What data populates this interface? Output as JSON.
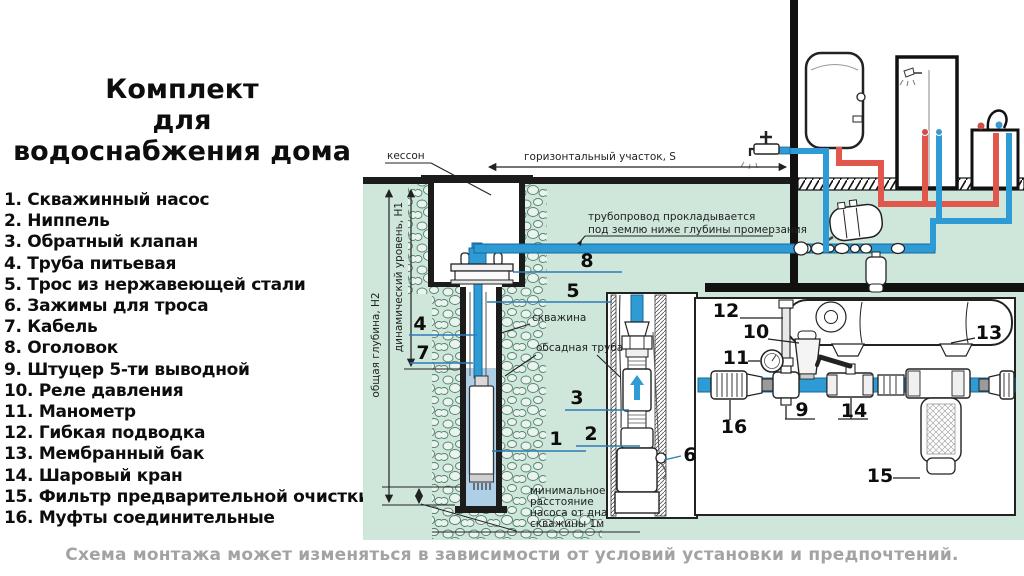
{
  "title": {
    "lines": [
      "Комплект",
      "для",
      "водоснабжения дома"
    ]
  },
  "legend": {
    "items": [
      "1. Скважинный насос",
      "2. Ниппель",
      "3. Обратный клапан",
      "4. Труба питьевая",
      "5. Трос из нержавеющей стали",
      "6. Зажимы для троса",
      "7. Кабель",
      "8. Оголовок",
      "9. Штуцер 5-ти выводной",
      "10. Реле давления",
      "11. Манометр",
      "12. Гибкая подводка",
      "13. Мембранный бак",
      "14. Шаровый кран",
      "15. Фильтр предварительной очистки",
      "16. Муфты соединительные"
    ]
  },
  "caption": {
    "text": "Схема монтажа может изменяться в зависимости от условий установки и предпочтений."
  },
  "diagram": {
    "labels": {
      "kesson": "кессон",
      "horizontal_section": "горизонтальный участок, S",
      "pipeline_note": [
        "трубопровод прокладывается",
        "под землю ниже глубины промерзания"
      ],
      "total_depth": "общая глубина, Н2",
      "dynamic_level": "динамический уровень, Н1",
      "borehole": "скважина",
      "casing": "обсадная труба",
      "min_distance": [
        "минимальное",
        "расстояние",
        "насоса от дна",
        "скважины 1м"
      ]
    },
    "callouts": {
      "n1": "1",
      "n2": "2",
      "n3": "3",
      "n4": "4",
      "n5": "5",
      "n6": "6",
      "n7": "7",
      "n8": "8",
      "n9": "9",
      "n10": "10",
      "n11": "11",
      "n12": "12",
      "n13": "13",
      "n14": "14",
      "n15": "15",
      "n16": "16"
    },
    "colors": {
      "ground": "#cfe7db",
      "water": "#aecfe6",
      "pipe_cold": "#2e9bd4",
      "pipe_cold_edge": "#16699c",
      "pipe_hot": "#e2574c",
      "callout_line": "#2b7cb4",
      "line": "#1a1a1a"
    }
  }
}
